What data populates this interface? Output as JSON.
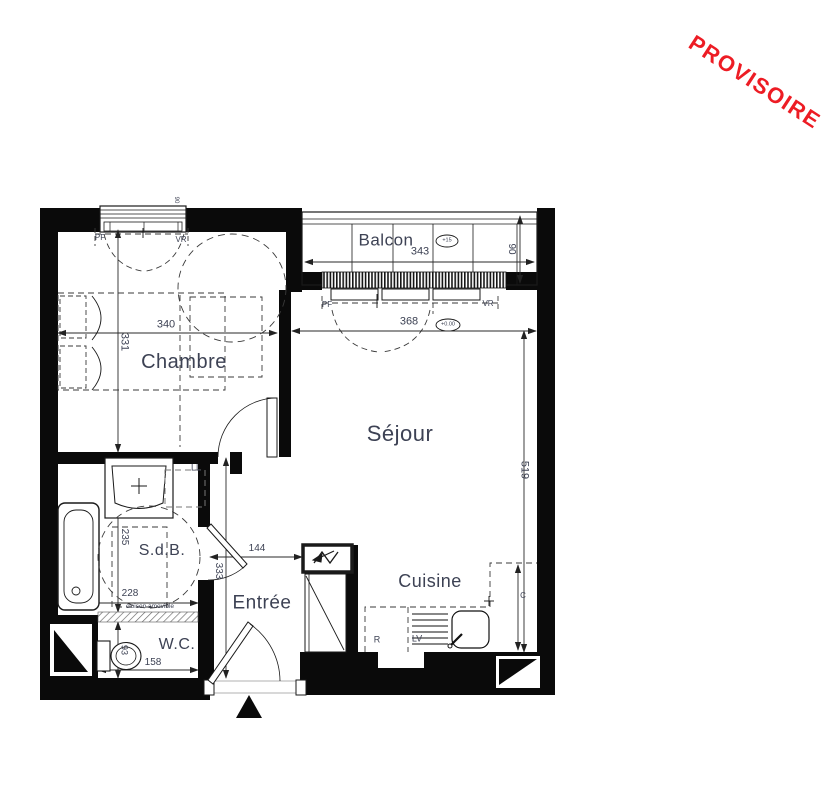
{
  "watermark": {
    "text": "PROVISOIRE",
    "color": "#ed1c24"
  },
  "rooms": {
    "balcon": "Balcon",
    "chambre": "Chambre",
    "sejour": "Séjour",
    "cuisine": "Cuisine",
    "sdb": "S.d.B.",
    "entree": "Entrée",
    "wc": "W.C."
  },
  "dims": {
    "balcon_width": "343",
    "balcon_depth": "90",
    "chambre_width": "340",
    "chambre_height": "331",
    "sejour_width": "368",
    "sejour_height": "519",
    "window_width": "90",
    "hall_width": "144",
    "hall_height": "333",
    "sdb_width": "228",
    "sdb_height": "235",
    "wc_width": "158",
    "wc_depth": "93"
  },
  "levels": {
    "balcon": "+15",
    "sejour": "+0.00"
  },
  "labels": {
    "pf": "PF",
    "vr": "VR",
    "ll": "LL",
    "r": "R",
    "lv": "LV",
    "c": "C",
    "cloison": "cloison amovible"
  }
}
